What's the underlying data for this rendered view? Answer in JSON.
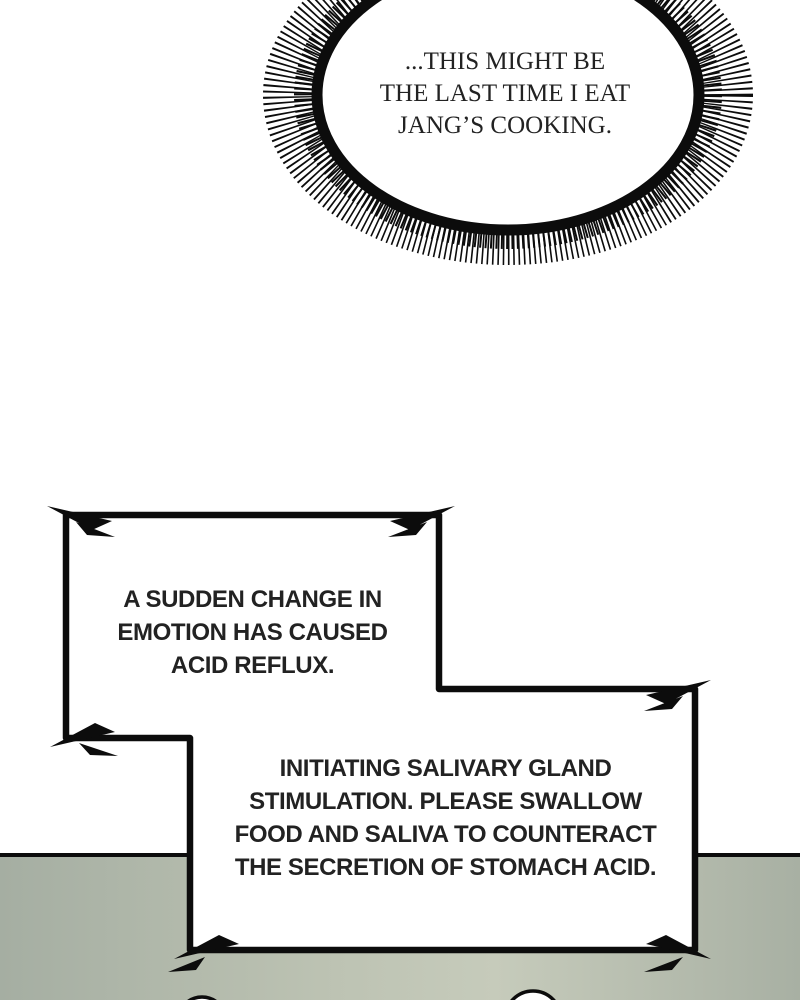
{
  "panel": {
    "type": "webtoon-comic-panel",
    "thought_bubble": {
      "style": "spiky-burst-ellipse",
      "text": "...THIS MIGHT BE\nTHE LAST TIME I EAT\nJANG’S COOKING."
    },
    "system_boxes": [
      {
        "style": "jagged-lightning-corner-box",
        "text": "A SUDDEN CHANGE IN\nEMOTION HAS CAUSED\nACID REFLUX."
      },
      {
        "style": "jagged-lightning-corner-box",
        "text": "INITIATING SALIVARY GLAND\nSTIMULATION. PLEASE SWALLOW\nFOOD AND SALIVA TO COUNTERACT\nTHE SECRETION OF STOMACH ACID."
      }
    ],
    "colors": {
      "background": "#ffffff",
      "ink": "#0c0c0c",
      "text": "#222222",
      "floor": "#a8b0a3",
      "floor_light": "#c6cbbb"
    }
  }
}
